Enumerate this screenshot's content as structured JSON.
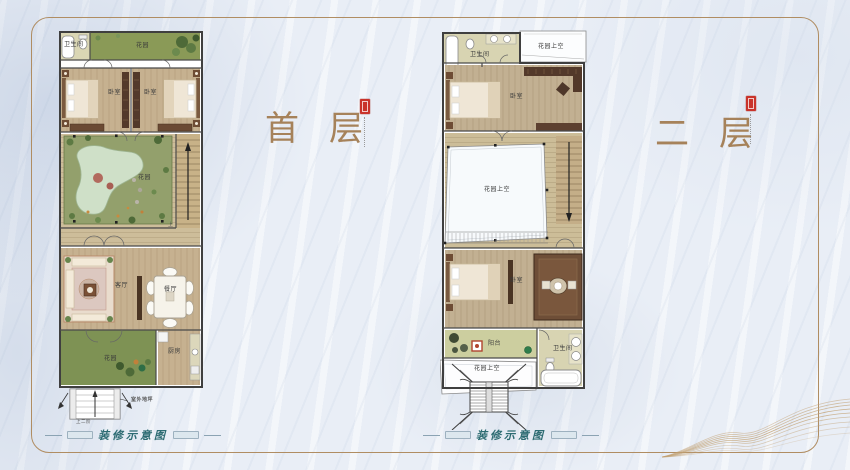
{
  "floor1": {
    "title": "首层",
    "caption": "装修示意图",
    "stair_direction": "上",
    "labels": {
      "bath": "卫生间",
      "garden_top": "花园",
      "bedroom_left": "卧室",
      "bedroom_right": "卧室",
      "courtyard_garden": "花园",
      "living_room": "客厅",
      "dining_room": "餐厅",
      "garden_bottom": "花园",
      "kitchen": "厨房",
      "outdoor_ground": "室外地坪",
      "entry_steps": "上二阶"
    }
  },
  "floor2": {
    "title": "二层",
    "caption": "装修示意图",
    "labels": {
      "bath_top": "卫生间",
      "garden_void_top": "花园上空",
      "bedroom_top": "卧室",
      "garden_void_middle": "花园上空",
      "bedroom_bottom": "卧室",
      "balcony": "阳台",
      "bath_bottom": "卫生间",
      "garden_void_bottom": "花园上空"
    }
  },
  "colors": {
    "title_bronze": "#a6825a",
    "caption_teal": "#2c6b72",
    "frame_line": "#b08d62",
    "seal_red": "#c9332b",
    "garden_green": "#8a9a57",
    "wood_floor": "#c6b190",
    "wall_dark": "#3f3f3f"
  },
  "icons": {
    "stairs_up": "up-arrow",
    "stairs_down": "down-arrow",
    "entry": "up-arrow"
  }
}
